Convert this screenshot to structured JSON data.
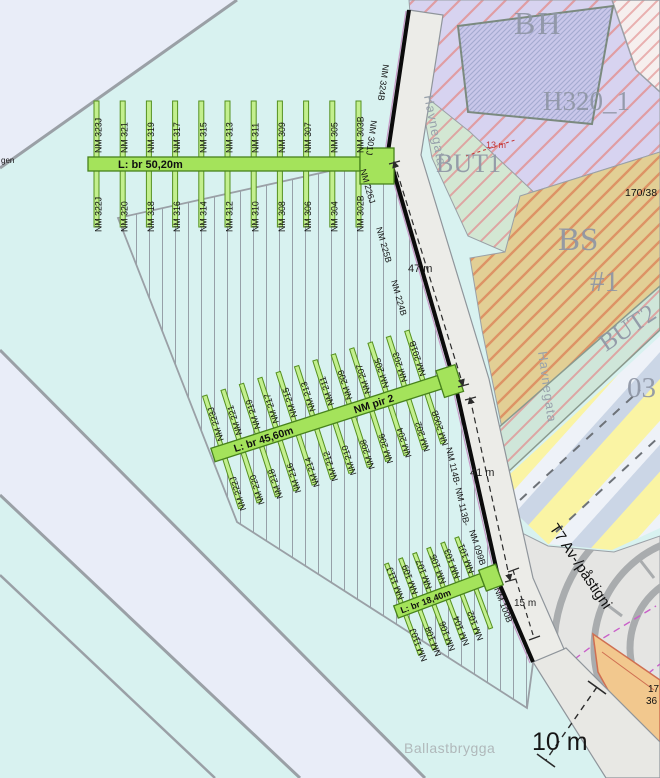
{
  "zones": {
    "bh": "BH",
    "h320": "H320_1",
    "but1": "BUT1",
    "bs": "BS",
    "bs_number": "#1",
    "but2": "BUT2",
    "o3": "03",
    "t7": "T7 Av-/påstigni"
  },
  "streets": {
    "havnegata_top": "Havnegata",
    "havnegata_bottom": "Havnegata",
    "ballastbrygga": "Ballastbrygga",
    "left_edge_partial": "gen"
  },
  "parcels": {
    "p170_38": "170/38",
    "p17": "17",
    "p36": "36"
  },
  "dimensions": {
    "d47": "47 m",
    "d41": "41 m",
    "d15": "15 m",
    "d13": "13 m",
    "d10": "10 m"
  },
  "piers": {
    "pier3_label": "L: br 50,20m",
    "pier2_label": "L: br 45,60m",
    "pier2_name": "NM pir 2",
    "pier1_label": "L: br 18,40m",
    "pier3_top": [
      "NM 323J",
      "NM 321",
      "NM 319",
      "NM 317",
      "NM 315",
      "NM 313",
      "NM 311",
      "NM 309",
      "NM 307",
      "NM 305",
      "NM 303B"
    ],
    "pier3_bottom": [
      "NM 322J",
      "NM 320",
      "NM 318",
      "NM 316",
      "NM 314",
      "NM 312",
      "NM 310",
      "NM 308",
      "NM 306",
      "NM 304",
      "NM 302B"
    ],
    "pier2_top": [
      "NM 223J",
      "NM 221",
      "NM 219",
      "NM 217",
      "NM 215",
      "NM 213",
      "NM 211",
      "NM 209",
      "NM 207",
      "NM 205",
      "NM 203",
      "NM 201B"
    ],
    "pier2_bottom": [
      "NM 222J",
      "NM 220",
      "NM 218",
      "NM 216",
      "NM 214",
      "NM 212",
      "NM 210",
      "NM 208",
      "NM 206",
      "NM 204",
      "NM 202",
      "NM 200B"
    ],
    "pier1_top": [
      "NM 111J",
      "NM 109",
      "NM 107",
      "NM 105",
      "NM 103",
      "NM 101"
    ],
    "pier1_bottom": [
      "NM 110J",
      "NM 108",
      "NM 106",
      "NM 104",
      "NM 102"
    ]
  },
  "edge_berths": {
    "e324": "NM 324B",
    "e301": "NM 301J",
    "e226": "NM 226J",
    "e225": "NM 225B",
    "e224": "NM 224B",
    "e114": "NM 114B- NM 113B-",
    "e099": "NM 099B",
    "e100": "NM 100B"
  },
  "colors": {
    "water": "#d8f2f0",
    "pier_green": "#a4e35b",
    "quay": "#ecece8",
    "zone_lavender": "#d7d3f0",
    "zone_green": "#d3e7d3",
    "zone_tan": "#e2cf95",
    "hatch_red": "#e29090",
    "magenta_line": "#c95fc9"
  }
}
